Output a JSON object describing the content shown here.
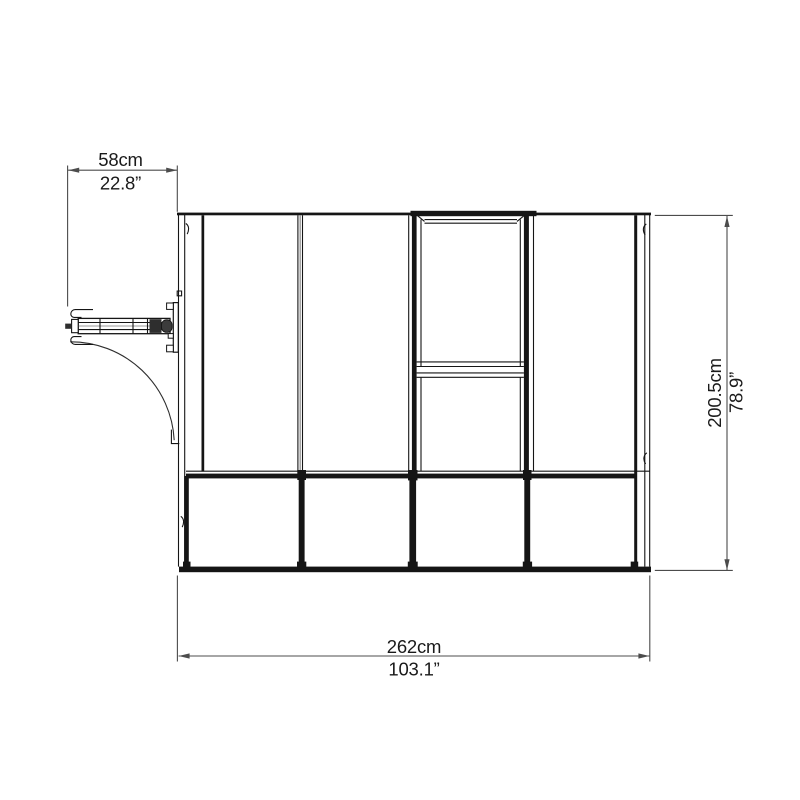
{
  "diagram": {
    "colors": {
      "background": "#ffffff",
      "structure_line": "#151515",
      "dimension_line": "#4c4c4c",
      "text": "#1a1a1a"
    },
    "dimensions": {
      "door_width": {
        "metric": "58cm",
        "imperial": "22.8”"
      },
      "overall_width": {
        "metric": "262cm",
        "imperial": "103.1”"
      },
      "overall_depth": {
        "metric": "200.5cm",
        "imperial": "78.9”"
      }
    }
  }
}
